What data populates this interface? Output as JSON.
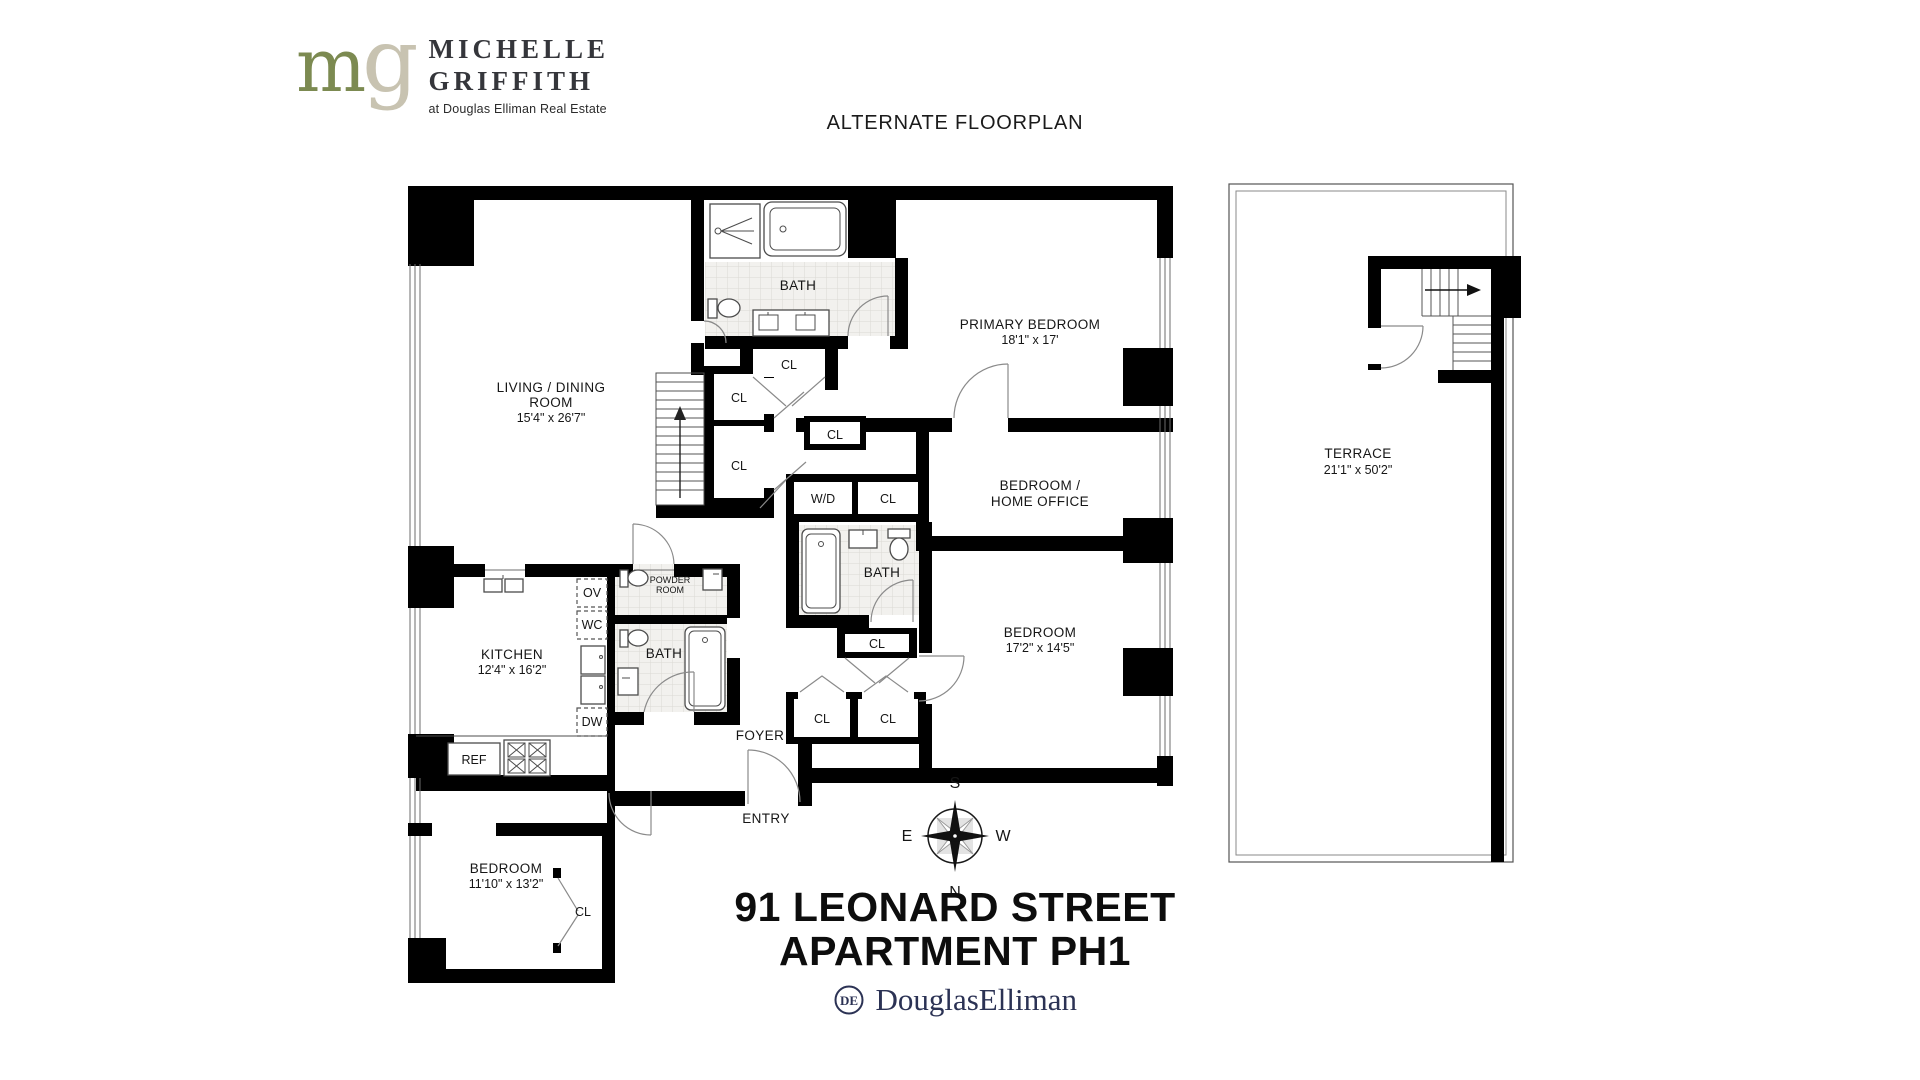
{
  "colors": {
    "logo_m": "#7c8a51",
    "logo_g": "#c8c3b1",
    "text_dark": "#35363b",
    "elliman_navy": "#2b3254",
    "wall": "#000000",
    "tile": "#f2f1ee"
  },
  "header": {
    "logo": {
      "m": "m",
      "g": "g",
      "line1": "MICHELLE",
      "line2": "GRIFFITH",
      "tagline": "at Douglas Elliman Real Estate"
    },
    "title": "ALTERNATE FLOORPLAN"
  },
  "plan": {
    "living": {
      "line1": "LIVING / DINING",
      "line2": "ROOM",
      "dims": "15'4\" x 26'7\""
    },
    "primary_bedroom": {
      "name": "PRIMARY BEDROOM",
      "dims": "18'1\" x 17'"
    },
    "home_office": {
      "line1": "BEDROOM /",
      "line2": "HOME OFFICE"
    },
    "bedroom2": {
      "name": "BEDROOM",
      "dims": "17'2\" x 14'5\""
    },
    "bedroom3": {
      "name": "BEDROOM",
      "dims": "11'10\" x 13'2\""
    },
    "kitchen": {
      "name": "KITCHEN",
      "dims": "12'4\" x 16'2\""
    },
    "powder_room": {
      "line1": "POWDER",
      "line2": "ROOM"
    },
    "foyer": "FOYER",
    "entry": "ENTRY",
    "labels": {
      "bath": "BATH",
      "cl": "CL",
      "wd": "W/D",
      "ov": "OV",
      "wc": "WC",
      "dw": "DW",
      "ref": "REF"
    }
  },
  "terrace": {
    "name": "TERRACE",
    "dims": "21'1\" x 50'2\""
  },
  "compass": {
    "n": "N",
    "s": "S",
    "e": "E",
    "w": "W"
  },
  "footer": {
    "address_line1": "91 LEONARD STREET",
    "address_line2": "APARTMENT PH1",
    "monogram": "DE",
    "brand": "DouglasElliman"
  }
}
